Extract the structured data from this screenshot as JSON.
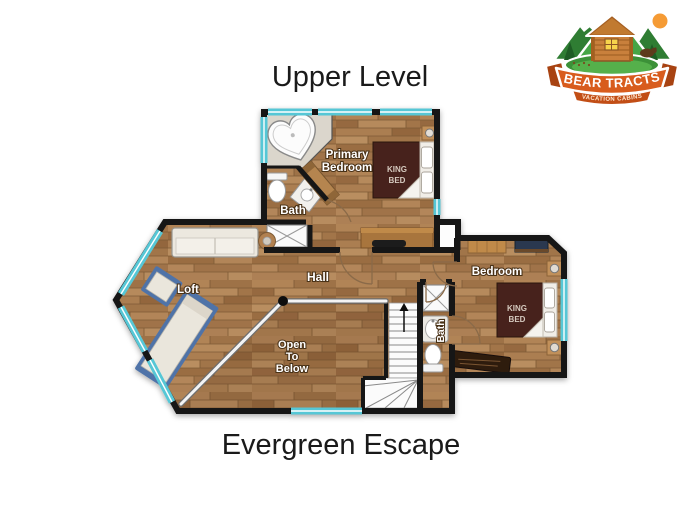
{
  "header": {
    "title": "Upper Level"
  },
  "footer": {
    "title": "Evergreen Escape"
  },
  "logo": {
    "name": "BEAR TRACTS",
    "tagline": "VACATION CABINS"
  },
  "floorplan": {
    "rooms": {
      "primary_bedroom": {
        "label_lines": [
          "Primary",
          "Bedroom"
        ],
        "bed_label_lines": [
          "KING",
          "BED"
        ]
      },
      "primary_bath": {
        "label": "Bath"
      },
      "loft": {
        "label": "Loft"
      },
      "hall": {
        "label": "Hall"
      },
      "open_to_below": {
        "label_lines": [
          "Open",
          "To",
          "Below"
        ]
      },
      "bedroom": {
        "label": "Bedroom",
        "bed_label_lines": [
          "KING",
          "BED"
        ]
      },
      "bath": {
        "label": "Bath"
      }
    },
    "colors": {
      "wall": "#161616",
      "window": "#57c7d6",
      "wood_floor": "#a87a4d",
      "bed": "#46211b",
      "fixture": "#fafafa",
      "futon_trim": "#4f73a8",
      "logo_banner": "#d85c1d",
      "logo_green": "#46a546"
    }
  }
}
